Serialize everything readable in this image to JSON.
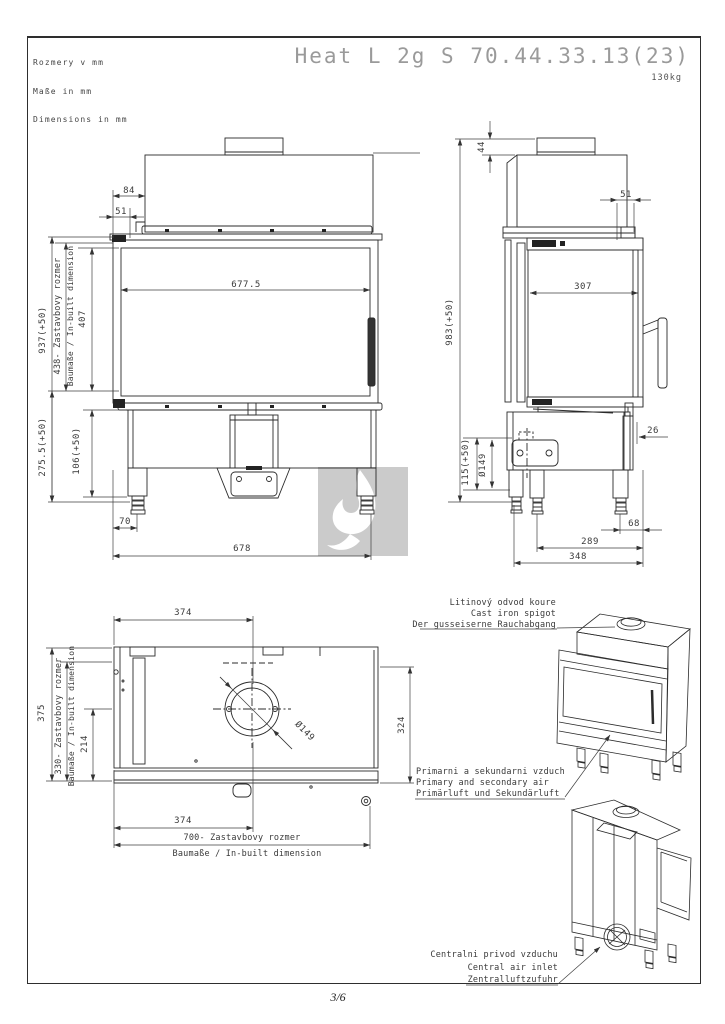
{
  "page": {
    "footer_page": "3/6"
  },
  "header": {
    "units_lines": [
      "Rozmery v mm",
      "Maße in mm",
      "Dimensions in mm"
    ],
    "title": "Heat L 2g S 70.44.33.13(23)",
    "weight": "130kg"
  },
  "views": {
    "front": {
      "dims": {
        "w84": "84",
        "w51": "51",
        "glass_w": "677.5",
        "glass_h": "407",
        "total_h": "937(+50)",
        "inbuilt_h": "438- Zastavbovy rozmer",
        "inbuilt_h2": "Baumaße / In-built dimension",
        "lower_h": "275.5(+50)",
        "base_h": "106(+50)",
        "foot_off": "70",
        "total_w": "678"
      }
    },
    "side": {
      "dims": {
        "stub_h": "44",
        "depth51": "51",
        "inner_d": "307",
        "total_h": "983(+50)",
        "inlet_h": "115(+50)",
        "inlet_d": "Ø149",
        "off26": "26",
        "off68": "68",
        "d289": "289",
        "d348": "348"
      }
    },
    "plan": {
      "dims": {
        "top374": "374",
        "left375": "375",
        "inbuilt330": "330- Zastavbovy rozmer",
        "inbuilt330b": "Baumaße / In-built dimension",
        "d214": "214",
        "flue_d": "Ø149",
        "right324": "324",
        "bot374": "374",
        "built700": "700- Zastavbovy rozmer",
        "built700b": "Baumaße / In-built dimension"
      }
    }
  },
  "annotations": {
    "spigot": {
      "lines": [
        "Litinový odvod koure",
        "Cast iron spigot",
        "Der gusseiserne Rauchabgang"
      ]
    },
    "air": {
      "lines": [
        "Primarni a sekundarni vzduch",
        "Primary and secondary air",
        "Primärluft und Sekundärluft"
      ]
    },
    "central": {
      "lines": [
        "Centralni privod vzduchu",
        "Central air inlet",
        "Zentralluftzufuhr"
      ]
    }
  },
  "colors": {
    "line": "#2b2b2b",
    "dim": "#3f3f3f",
    "text": "#3a3a3a",
    "title_gray": "#9a9a9a",
    "watermark_gray": "#cbcbcb"
  }
}
